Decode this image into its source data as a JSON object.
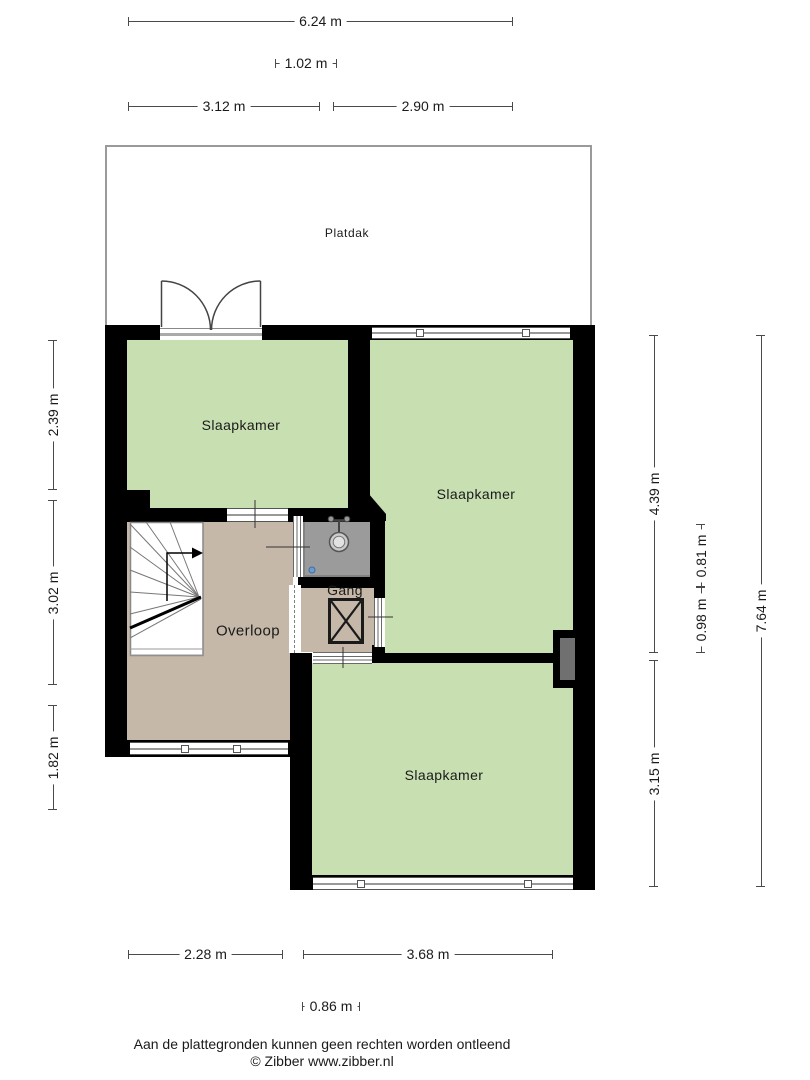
{
  "floorplan": {
    "rooms": {
      "platdak": {
        "label": "Platdak"
      },
      "slaapkamer_topleft": {
        "label": "Slaapkamer"
      },
      "slaapkamer_right": {
        "label": "Slaapkamer"
      },
      "slaapkamer_bottom": {
        "label": "Slaapkamer"
      },
      "overloop": {
        "label": "Overloop"
      },
      "gang": {
        "label": "Gang"
      }
    },
    "dimensions": {
      "top": {
        "total": "6.24 m",
        "door": "1.02 m",
        "left_section": "3.12 m",
        "right_section": "2.90 m"
      },
      "left": {
        "top_section": "2.39 m",
        "middle_section": "3.02 m",
        "bottom_section": "1.82 m"
      },
      "right": {
        "upper_section": "4.39 m",
        "lower_section": "3.15 m",
        "toilet_depth": "0.81 m",
        "gang_depth": "0.98 m",
        "total": "7.64 m"
      },
      "bottom": {
        "left_section": "2.28 m",
        "right_section": "3.68 m",
        "gang_width": "0.86 m"
      }
    },
    "colors": {
      "room_floor_green": "#c8dfb2",
      "landing_floor_tan": "#c5b8a8",
      "toilet_floor_gray": "#9b9b9b",
      "wall_black": "#000000"
    }
  },
  "footer": {
    "disclaimer": "Aan de plattegronden kunnen geen rechten worden ontleend",
    "credit": "© Zibber www.zibber.nl"
  }
}
